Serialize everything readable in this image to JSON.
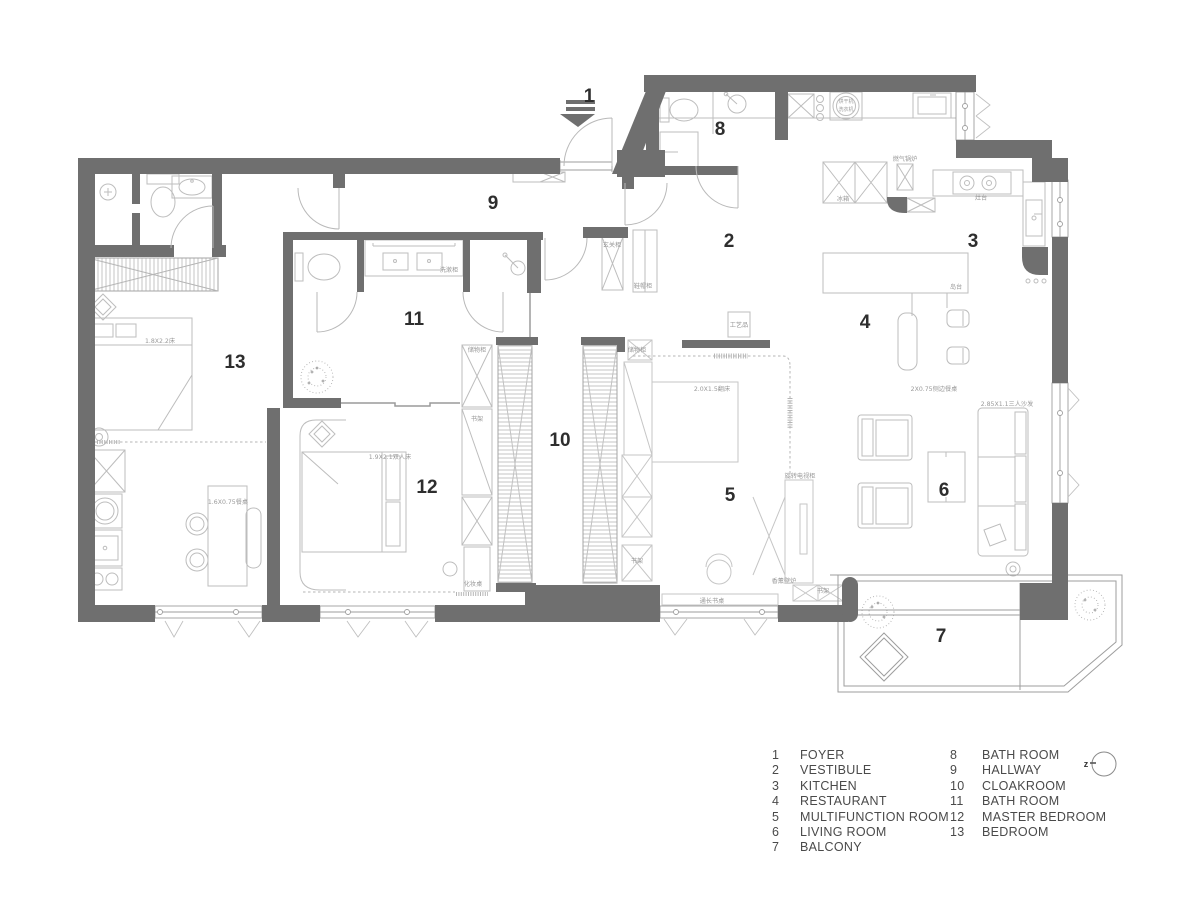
{
  "plan": {
    "rooms": [
      {
        "number": "1",
        "name": "FOYER"
      },
      {
        "number": "2",
        "name": "VESTIBULE"
      },
      {
        "number": "3",
        "name": "KITCHEN"
      },
      {
        "number": "4",
        "name": "RESTAURANT"
      },
      {
        "number": "5",
        "name": "MULTIFUNCTION ROOM"
      },
      {
        "number": "6",
        "name": "LIVING ROOM"
      },
      {
        "number": "7",
        "name": "BALCONY"
      },
      {
        "number": "8",
        "name": "BATH ROOM"
      },
      {
        "number": "9",
        "name": "HALLWAY"
      },
      {
        "number": "10",
        "name": "CLOAKROOM"
      },
      {
        "number": "11",
        "name": "BATH ROOM"
      },
      {
        "number": "12",
        "name": "MASTER BEDROOM"
      },
      {
        "number": "13",
        "name": "BEDROOM"
      }
    ],
    "annotations": [
      {
        "text": "冰箱"
      },
      {
        "text": "烘干机"
      },
      {
        "text": "洗衣机"
      },
      {
        "text": "燃气锅炉"
      },
      {
        "text": "灶台"
      },
      {
        "text": "岛台"
      },
      {
        "text": "2X0.75侧边餐桌"
      },
      {
        "text": "2.85X1.1三人沙发"
      },
      {
        "text": "玄关柜"
      },
      {
        "text": "鞋帽柜"
      },
      {
        "text": "工艺品"
      },
      {
        "text": "2.0X1.5翻床"
      },
      {
        "text": "储物柜"
      },
      {
        "text": "书架"
      },
      {
        "text": "通长书桌"
      },
      {
        "text": "书架"
      },
      {
        "text": "1.9X2.1双人床"
      },
      {
        "text": "储物柜"
      },
      {
        "text": "书架"
      },
      {
        "text": "化妆桌"
      },
      {
        "text": "1.6X0.75餐桌"
      },
      {
        "text": "1.8X2.2床"
      },
      {
        "text": "洗漱柜"
      },
      {
        "text": "旋转电视柜"
      },
      {
        "text": "香薰壁炉"
      }
    ]
  },
  "legend": {
    "col1": [
      {
        "num": "1",
        "label": "FOYER"
      },
      {
        "num": "2",
        "label": "VESTIBULE"
      },
      {
        "num": "3",
        "label": "KITCHEN"
      },
      {
        "num": "4",
        "label": "RESTAURANT"
      },
      {
        "num": "5",
        "label": "MULTIFUNCTION ROOM"
      },
      {
        "num": "6",
        "label": "LIVING ROOM"
      },
      {
        "num": "7",
        "label": "BALCONY"
      }
    ],
    "col2": [
      {
        "num": "8",
        "label": "BATH ROOM"
      },
      {
        "num": "9",
        "label": "HALLWAY"
      },
      {
        "num": "10",
        "label": "CLOAKROOM"
      },
      {
        "num": "11",
        "label": "BATH ROOM"
      },
      {
        "num": "12",
        "label": "MASTER BEDROOM"
      },
      {
        "num": "13",
        "label": "BEDROOM"
      }
    ]
  },
  "north": {
    "label": "z"
  },
  "colors": {
    "wall": "#6f6f6f",
    "furniture_line": "#b9b9b9",
    "text": "#2e2e2e",
    "legend_text": "#4a4a4a"
  }
}
